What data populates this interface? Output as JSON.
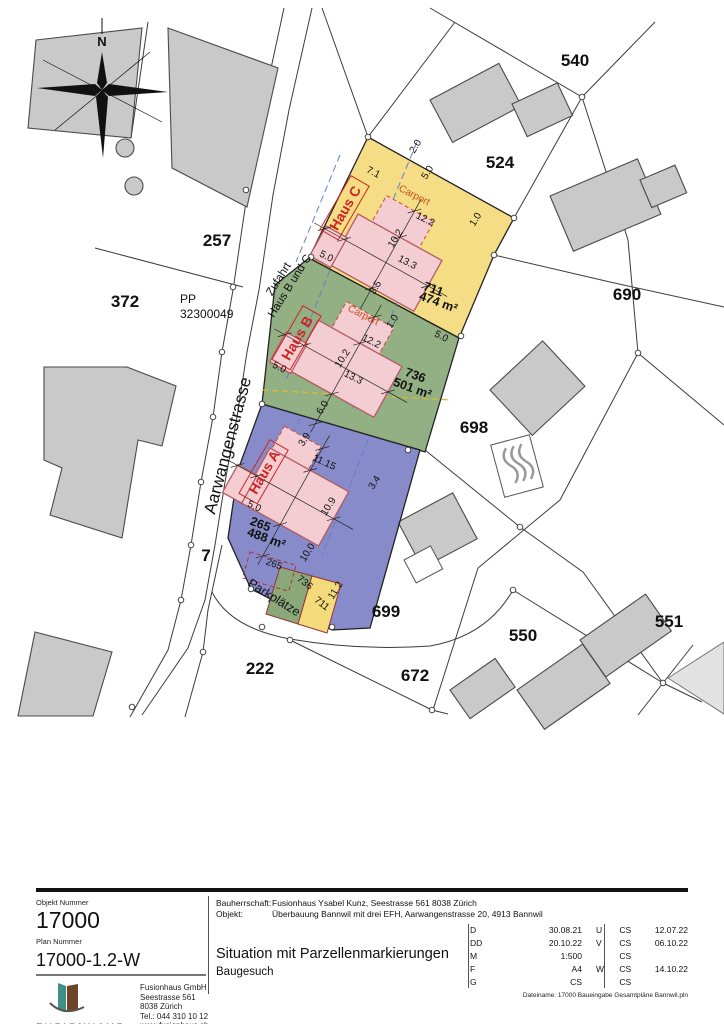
{
  "map": {
    "north": "N",
    "labels": {
      "n540": "540",
      "n524": "524",
      "n257": "257",
      "n372": "372",
      "n690": "690",
      "n698": "698",
      "n699": "699",
      "n550": "550",
      "n551": "551",
      "n672": "672",
      "n222": "222",
      "n7": "7"
    },
    "pp_line1": "PP",
    "pp_line2": "32300049",
    "streets": {
      "aarwangenstrasse": "Aarwangenstrasse",
      "zufahrt_line1": "Zufahrt",
      "zufahrt_line2": "Haus B und C",
      "parkplaetze": "Parkplätze"
    },
    "houses": {
      "a": "Haus A",
      "b": "Haus B",
      "c": "Haus C",
      "carport": "Carport"
    },
    "areas": {
      "c_no": "711",
      "c_area": "474 m²",
      "b_no": "736",
      "b_area": "501 m²",
      "a_no": "265",
      "a_area": "488 m²",
      "small_blue": "265",
      "small_green": "736",
      "small_yellow": "711"
    },
    "dims": {
      "c20": "2.0",
      "c50top": "5.0",
      "c71": "7.1",
      "c122": "12.2",
      "c102": "10.2",
      "c10": "1.0",
      "c133": "13.3",
      "c50left": "5.0",
      "c35": "3.5",
      "b10": "1.0",
      "b122": "12.2",
      "b102": "10.2",
      "b133": "13.3",
      "b50right": "5.0",
      "b50left": "5.0",
      "b60": "6.0",
      "b39": "3.9",
      "a1115": "11.15",
      "a34": "3.4",
      "a109": "10.9",
      "a50": "5.0",
      "a100": "10.0",
      "a112": "11.2"
    },
    "colors": {
      "parcel_yellow": "#f3da7b",
      "parcel_green": "#8aa87a",
      "parcel_blue": "#7d81c4",
      "new_building": "#f3cdd2",
      "new_building_stroke": "#b35a62",
      "existing_building": "#c9c9c9",
      "haus_label": "#cc2424",
      "carport_text": "#c8501e",
      "axis_dashed": "#6080c8",
      "utility_dashed": "#ddb830"
    }
  },
  "titleblock": {
    "object_number_label": "Objekt Nummer",
    "object_number": "17000",
    "plan_number_label": "Plan Nummer",
    "plan_number": "17000-1.2-W",
    "logo_text": "FUSIONHAUS",
    "company": {
      "name": "Fusionhaus GmbH",
      "street": "Seestrasse 561",
      "city": "8038 Zürich",
      "phone": "Tel.: 044 310 10 12",
      "web": "www.fusionhaus.ch"
    },
    "bauherrschaft_label": "Bauherrschaft:",
    "bauherrschaft": "Fusionhaus Ysabel Kunz, Seestrasse 561 8038 Zürich",
    "objekt_label": "Objekt:",
    "objekt": "Überbauung Bannwil mit drei EFH, Aarwangenstrasse 20, 4913 Bannwil",
    "title": "Situation mit Parzellenmarkierungen",
    "subtitle": "Baugesuch",
    "revisions_left": [
      {
        "key": "D",
        "value": "30.08.21"
      },
      {
        "key": "DD",
        "value": "20.10.22"
      },
      {
        "key": "M",
        "value": "1:500"
      },
      {
        "key": "F",
        "value": "A4"
      },
      {
        "key": "G",
        "value": "CS"
      }
    ],
    "revisions_right": [
      {
        "key": "U",
        "initials": "CS",
        "date": "12.07.22"
      },
      {
        "key": "V",
        "initials": "CS",
        "date": "06.10.22"
      },
      {
        "key": "",
        "initials": "CS",
        "date": ""
      },
      {
        "key": "W",
        "initials": "CS",
        "date": "14.10.22"
      },
      {
        "key": "",
        "initials": "CS",
        "date": ""
      }
    ],
    "filename": "Dateiname: 17000 Baueingabe Gesamtpläne Bannwil.pln"
  }
}
